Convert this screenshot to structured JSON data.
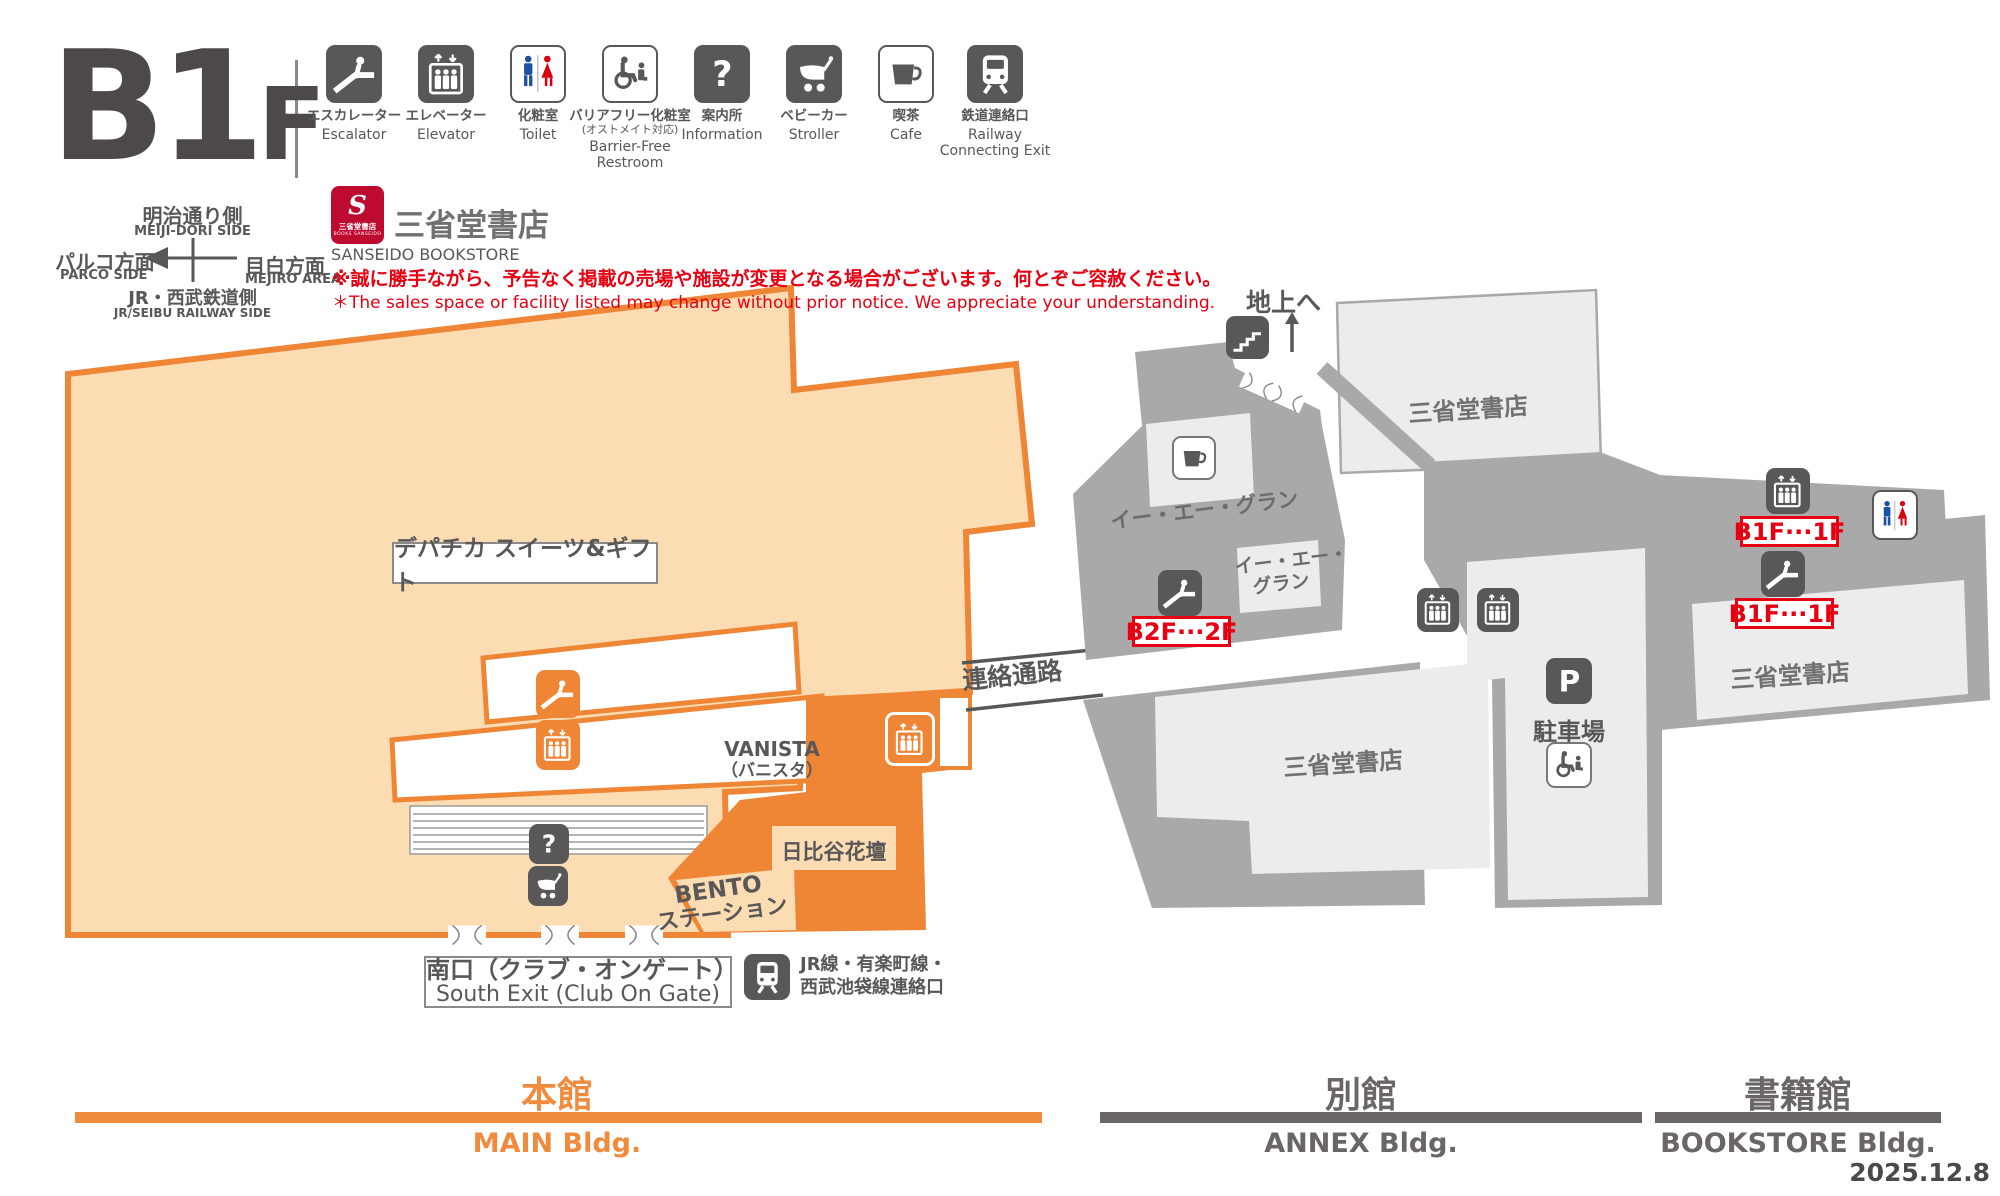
{
  "floor": {
    "big": "B1",
    "small": "F"
  },
  "legend": [
    {
      "jp": "エスカレーター",
      "en1": "Escalator",
      "icon": "escalator-icon"
    },
    {
      "jp": "エレベーター",
      "en1": "Elevator",
      "icon": "elevator-icon"
    },
    {
      "jp": "化粧室",
      "en1": "Toilet",
      "icon": "toilet-icon"
    },
    {
      "jp": "バリアフリー化粧室",
      "jp2": "(オストメイト対応)",
      "en1": "Barrier-Free",
      "en2": "Restroom",
      "icon": "barrier-free-icon"
    },
    {
      "jp": "案内所",
      "en1": "Information",
      "icon": "information-icon"
    },
    {
      "jp": "ベビーカー",
      "en1": "Stroller",
      "icon": "stroller-icon"
    },
    {
      "jp": "喫茶",
      "en1": "Cafe",
      "icon": "cafe-icon"
    },
    {
      "jp": "鉄道連絡口",
      "en1": "Railway",
      "en2": "Connecting Exit",
      "icon": "railway-icon"
    }
  ],
  "compass": {
    "north_jp": "明治通り側",
    "north_en": "MEIJI-DORI SIDE",
    "west_jp": "パルコ方面",
    "west_en": "PARCO SIDE",
    "east_jp": "目白方面",
    "east_en": "MEJIRO AREA",
    "south_jp": "JR・西武鉄道側",
    "south_en": "JR/SEIBU RAILWAY SIDE"
  },
  "store": {
    "logo_initial": "S",
    "logo_text": "三省堂書店",
    "logo_sub": "BOOKS SANSEIDO",
    "name": "三省堂書店",
    "name_en": "SANSEIDO BOOKSTORE"
  },
  "notice": {
    "jp": "※誠に勝手ながら、予告なく掲載の売場や施設が変更となる場合がございます。何とぞご容赦ください。",
    "en": "＊The sales space or facility listed may change without prior notice. We appreciate your understanding."
  },
  "map": {
    "depachika": "デパチカ スイーツ&ギフト",
    "vanista": "VANISTA",
    "vanista_kana": "（バニスタ）",
    "hibiya": "日比谷花壇",
    "bento1": "BENTO",
    "bento2": "ステーション",
    "south_exit_jp": "南口（クラブ・オンゲート）",
    "south_exit_en": "South Exit (Club On Gate)",
    "rail1": "JR線・有楽町線・",
    "rail2": "西武池袋線連絡口",
    "corridor": "連絡通路",
    "to_ground": "地上へ",
    "ea_gran": "イー・エー・グラン",
    "ea_gran_a": "イー・エー・",
    "ea_gran_b": "グラン",
    "b2f_2f": "B2F···2F",
    "b1f_1f_elevator": "B1F···1F",
    "b1f_1f_escalator": "B1F···1F",
    "sanseido_top": "三省堂書店",
    "sanseido_annex": "三省堂書店",
    "sanseido_book": "三省堂書店",
    "parking": "駐車場"
  },
  "footer": {
    "main_jp": "本館",
    "main_en": "MAIN Bldg.",
    "annex_jp": "別館",
    "annex_en": "ANNEX Bldg.",
    "book_jp": "書籍館",
    "book_en": "BOOKSTORE Bldg.",
    "date": "2025.12.8"
  },
  "colors": {
    "accent_orange": "#ef8636",
    "peach": "#fbdcb3",
    "dark_gray": "#595757",
    "annex_gray": "#a9a9a9",
    "room_light": "#ececec",
    "alert_red": "#e60012",
    "toilet_blue": "#1d50a2",
    "toilet_red": "#d7000f",
    "logo_red": "#bf0a30"
  }
}
